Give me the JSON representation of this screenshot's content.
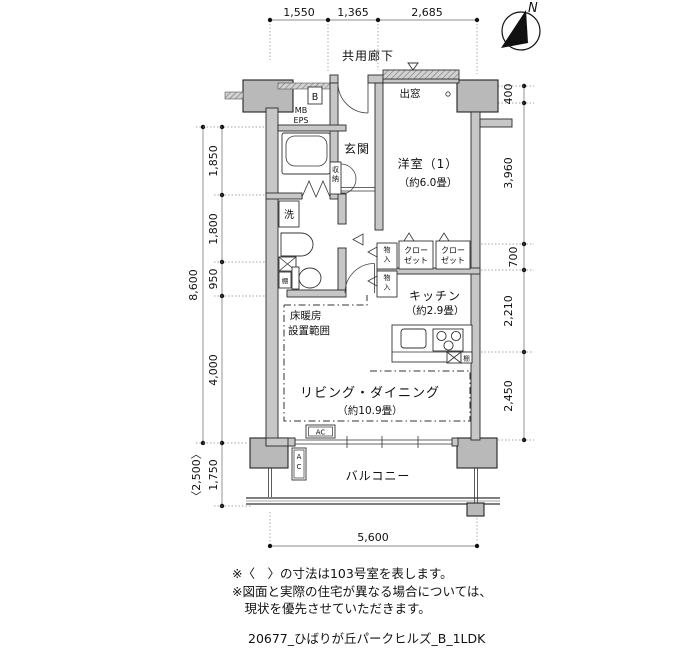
{
  "meta": {
    "bg_color": "#ffffff",
    "wall_color": "#c7c7c7",
    "column_color": "#b9b9b9",
    "line_color": "#2a2a2a"
  },
  "compass": {
    "label": "N"
  },
  "header": {
    "corridor_label": "共用廊下"
  },
  "dims": {
    "top": [
      "1,550",
      "1,365",
      "2,685"
    ],
    "left_total": "8,600",
    "left_segments": [
      "1,850",
      "1,800",
      "950",
      "4,000"
    ],
    "balcony_depth": "1,750",
    "balcony_alt": "〈2,500〉",
    "right": [
      "400",
      "3,960",
      "700",
      "2,210",
      "2,450"
    ],
    "bottom": "5,600"
  },
  "rooms": {
    "genkan": "玄関",
    "bedroom": {
      "name": "洋室（1）",
      "size": "（約6.0畳）"
    },
    "baywindow": "出窓",
    "kitchen": {
      "name": "キッチン",
      "size": "（約2.9畳）"
    },
    "living": {
      "name": "リビング・ダイニング",
      "size": "（約10.9畳）"
    },
    "balcony": "バルコニー",
    "floorheating": {
      "line1": "床暖房",
      "line2": "設置範囲"
    }
  },
  "fixtures": {
    "b_box": "B",
    "mb": "MB",
    "eps": "EPS",
    "washer": "洗",
    "shunou": "収納",
    "monoire": "物入",
    "closet": {
      "line1": "クロー",
      "line2": "ゼット"
    },
    "tana": "棚",
    "ac": "AC"
  },
  "notes": {
    "line1": "※〈　〉の寸法は103号室を表します。",
    "line2": "※図面と実際の住宅が異なる場合については、",
    "line3": "　現状を優先させていただきます。",
    "footer": "20677_ひばりが丘パークヒルズ_B_1LDK"
  }
}
